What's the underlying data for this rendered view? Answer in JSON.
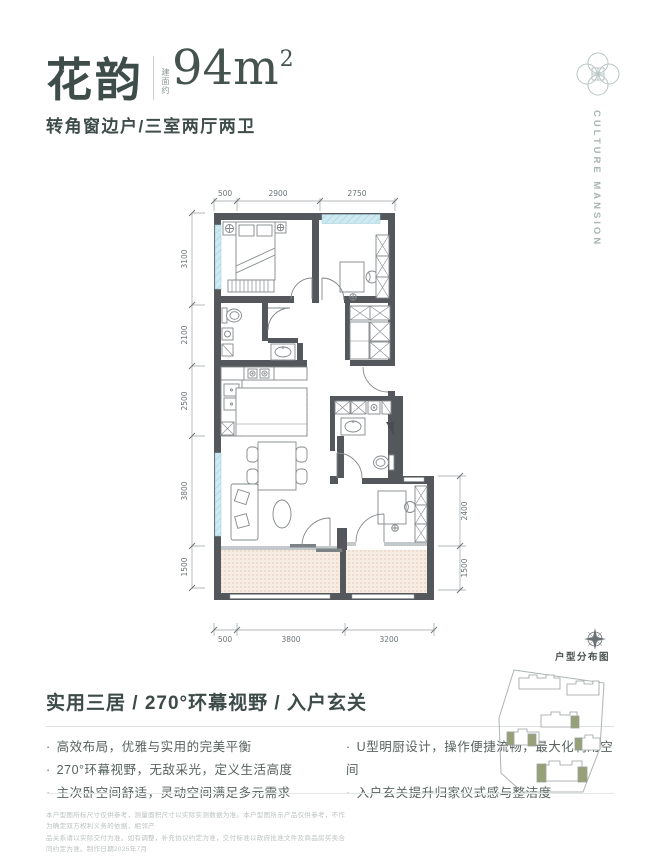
{
  "header": {
    "name": "花韵",
    "area_prefix": "建面约",
    "area_value": "94m",
    "area_sup": "2",
    "subtitle": "转角窗边户/三室两厅两卫"
  },
  "brand": {
    "logo_icon": "quatrefoil-emblem",
    "wordmark": "CULTURE MANSION"
  },
  "plan": {
    "dims": {
      "top": [
        "500",
        "2900",
        "2750"
      ],
      "left": [
        "3100",
        "2100",
        "2500",
        "3800",
        "1500"
      ],
      "right": [
        "2400",
        "1500"
      ],
      "bottom": [
        "500",
        "3800",
        "3200"
      ]
    }
  },
  "features": {
    "headline": "实用三居 / 270°环幕视野 / 入户玄关",
    "left": [
      "高效布局，优雅与实用的完美平衡",
      "270°环幕视野，无敌采光，定义生活高度",
      "主次卧空间舒适，灵动空间满足多元需求"
    ],
    "right": [
      "U型明厨设计，操作便捷流畅，最大化利用空间",
      "入户玄关提升归家仪式感与整洁度"
    ]
  },
  "siteplan": {
    "label": "户型分布图",
    "compass_icon": "compass-rose"
  },
  "disclaimer": {
    "line1": "本户型图所标尺寸仅供参考，测量面积尺寸以实际实测数据为准。本户型图所示产品仅供参考，不作为确定双方权利义务的依据，相邻产",
    "line2": "品关系请以实际交付为准。如有调整，补充协议约定为准，交付标准以政府批准文件及商品房买卖合同约定为准。制作日期2025年7月"
  },
  "colors": {
    "accent": "#3e4c4a",
    "wall": "#54585c",
    "window_blue": "#cfe9f1",
    "balcony_fill": "#f7ece2",
    "olive_building": "#97a077",
    "brand_gray": "#a8b5b2"
  }
}
